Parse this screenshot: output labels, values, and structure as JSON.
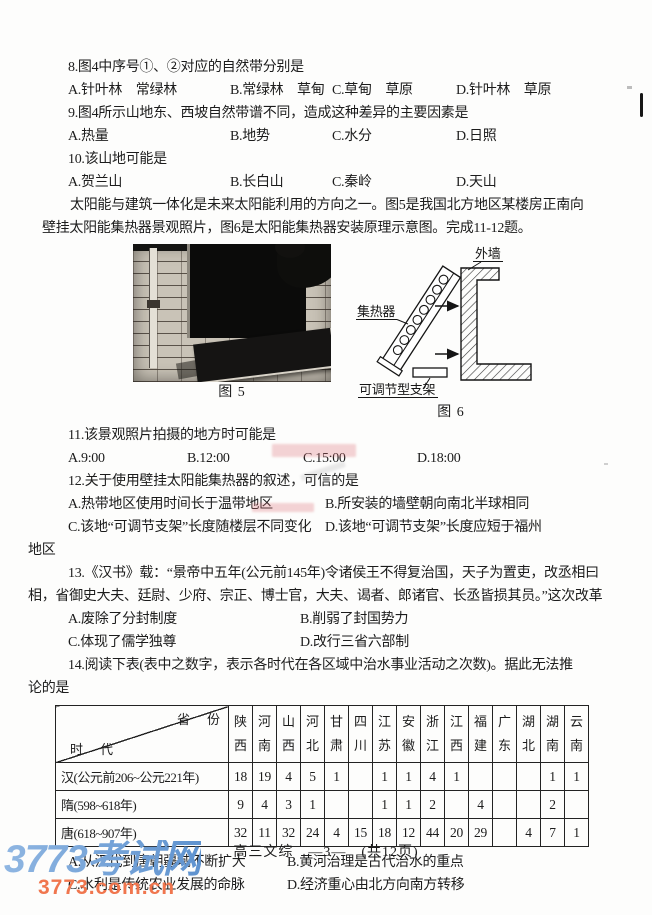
{
  "page": {
    "footer": "高三文综　—3—　(共12页)"
  },
  "site_watermark": {
    "name": "3773考试网",
    "url": "3773.com.cn"
  },
  "q8": {
    "stem": "8.图4中序号①、②对应的自然带分别是",
    "options": [
      "A.针叶林　常绿林",
      "B.常绿林　草甸",
      "C.草甸　草原",
      "D.针叶林　草原"
    ]
  },
  "q9": {
    "stem": "9.图4所示山地东、西坡自然带谱不同，造成这种差异的主要因素是",
    "options": [
      "A.热量",
      "B.地势",
      "C.水分",
      "D.日照"
    ]
  },
  "q10": {
    "stem": "10.该山地可能是",
    "options": [
      "A.贺兰山",
      "B.长白山",
      "C.秦岭",
      "D.天山"
    ]
  },
  "solar_passage": {
    "line1": "太阳能与建筑一体化是未来太阳能利用的方向之一。图5是我国北方地区某楼房正南向",
    "line2": "壁挂太阳能集热器景观照片，图6是太阳能集热器安装原理示意图。完成11-12题。"
  },
  "figures": {
    "fig5_caption": "图 5",
    "fig6_caption": "图 6",
    "fig6_labels": {
      "wall": "外墙",
      "collector": "集热器",
      "bracket": "可调节型支架"
    }
  },
  "q11": {
    "stem": "11.该景观照片拍摄的地方时可能是",
    "options": [
      "A.9:00",
      "B.12:00",
      "C.15:00",
      "D.18:00"
    ]
  },
  "q12": {
    "stem": "12.关于使用壁挂太阳能集热器的叙述，可信的是",
    "options": [
      "A.热带地区使用时间长于温带地区",
      "B.所安装的墙壁朝向南北半球相同",
      "C.该地“可调节支架”长度随楼层不同变化",
      "D.该地“可调节支架”长度应短于福州"
    ],
    "hang": "地区"
  },
  "q13": {
    "stem_line1": "13.《汉书》载：“景帝中五年(公元前145年)令诸侯王不得复治国，天子为置吏，改丞相曰",
    "stem_line2": "相，省御史大夫、廷尉、少府、宗正、博士官，大夫、谒者、郎诸官、长丞皆损其员。”这次改革",
    "options": [
      "A.废除了分封制度",
      "B.削弱了封国势力",
      "C.体现了儒学独尊",
      "D.改行三省六部制"
    ]
  },
  "q14": {
    "stem_line1": "14.阅读下表(表中之数字，表示各时代在各区域中治水事业活动之次数)。据此无法推",
    "stem_line2": "论的是",
    "options": [
      "A.从汉代到唐朝疆域不断扩大",
      "B.黄河治理是古代治水的重点",
      "C.水利是传统农业发展的命脉",
      "D.经济重心由北方向南方转移"
    ],
    "table": {
      "corner_top": "省　份",
      "corner_bottom": "时　代",
      "provinces": [
        "陕西",
        "河南",
        "山西",
        "河北",
        "甘肃",
        "四川",
        "江苏",
        "安徽",
        "浙江",
        "江西",
        "福建",
        "广东",
        "湖北",
        "湖南",
        "云南"
      ],
      "rows": [
        {
          "era": "汉(公元前206~公元221年)",
          "values": [
            "18",
            "19",
            "4",
            "5",
            "1",
            "",
            "1",
            "1",
            "4",
            "1",
            "",
            "",
            "",
            "1",
            "1"
          ]
        },
        {
          "era": "隋(598~618年)",
          "values": [
            "9",
            "4",
            "3",
            "1",
            "",
            "",
            "1",
            "1",
            "2",
            "",
            "4",
            "",
            "",
            "2",
            ""
          ]
        },
        {
          "era": "唐(618~907年)",
          "values": [
            "32",
            "11",
            "32",
            "24",
            "4",
            "15",
            "18",
            "12",
            "44",
            "20",
            "29",
            "",
            "4",
            "7",
            "1"
          ]
        }
      ]
    }
  }
}
